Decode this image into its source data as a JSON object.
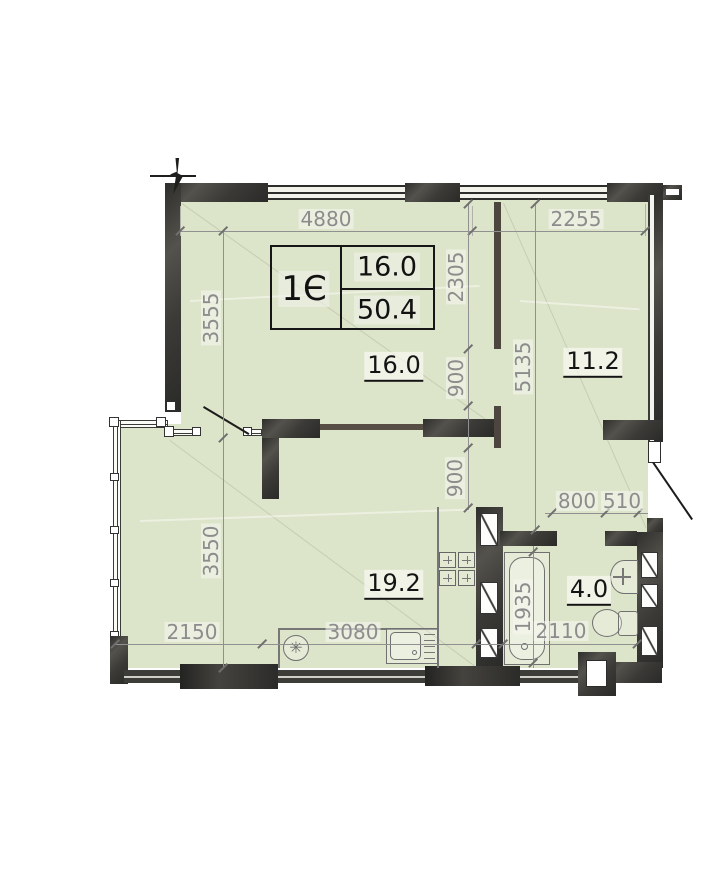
{
  "plan": {
    "title_block": {
      "unit": "1Є",
      "area_top": "16.0",
      "area_bottom": "50.4"
    },
    "rooms": {
      "living": {
        "area": "16.0"
      },
      "hall": {
        "area": "11.2"
      },
      "kitchen": {
        "area": "19.2"
      },
      "bath": {
        "area": "4.0"
      }
    },
    "dimensions": {
      "d4880": "4880",
      "d2255": "2255",
      "d3555": "3555",
      "d3550": "3550",
      "d2305": "2305",
      "d900a": "900",
      "d900b": "900",
      "d5135": "5135",
      "d800": "800",
      "d510": "510",
      "d2150": "2150",
      "d3080": "3080",
      "d1935": "1935",
      "d2110": "2110"
    },
    "icons": {
      "fridge": "✳"
    },
    "colors": {
      "floor": "#dce4c9",
      "wall": "#3a3a38",
      "dim": "#8c8c8c"
    }
  }
}
